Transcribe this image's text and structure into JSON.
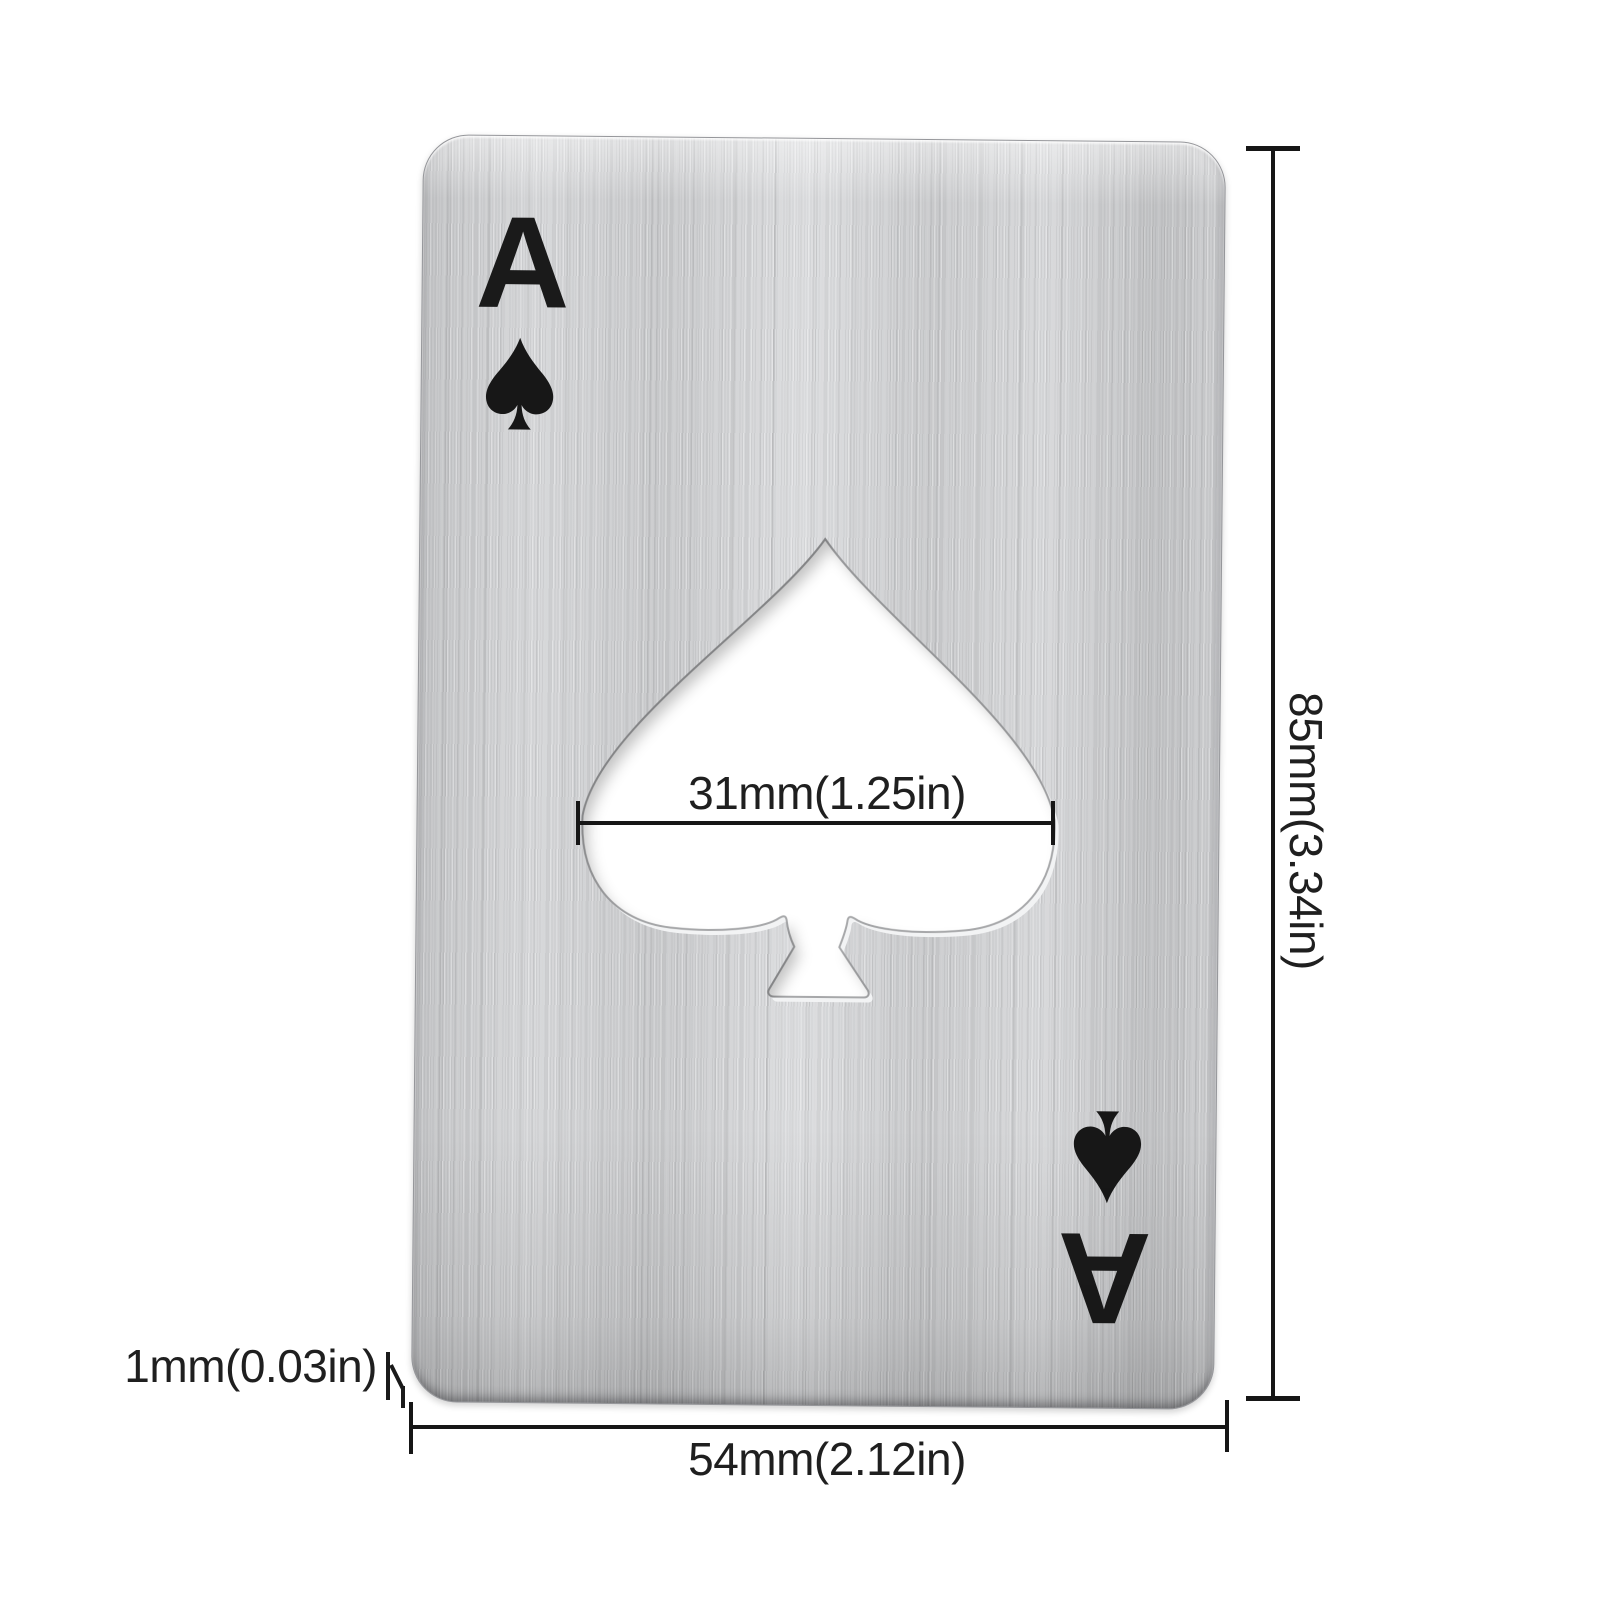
{
  "card": {
    "rank": "A",
    "suit": "spade",
    "suit_glyph": "♠",
    "material": "brushed stainless steel"
  },
  "annotations": {
    "cutout_width": "31mm(1.25in)",
    "card_height": "85mm(3.34in)",
    "card_width": "54mm(2.12in)",
    "thickness": "1mm(0.03in)"
  },
  "icons": {
    "top_left": "spade-icon",
    "bottom_right": "spade-icon",
    "center": "spade-cutout-hole",
    "thickness_pointer": "thickness-leader-arrow"
  },
  "colors": {
    "background": "#ffffff",
    "metal_light": "#dedfe1",
    "metal_base": "#cfd0d2",
    "metal_dark": "#c2c3c5",
    "ink": "#1a1a1a",
    "dimension_line": "#161616"
  }
}
